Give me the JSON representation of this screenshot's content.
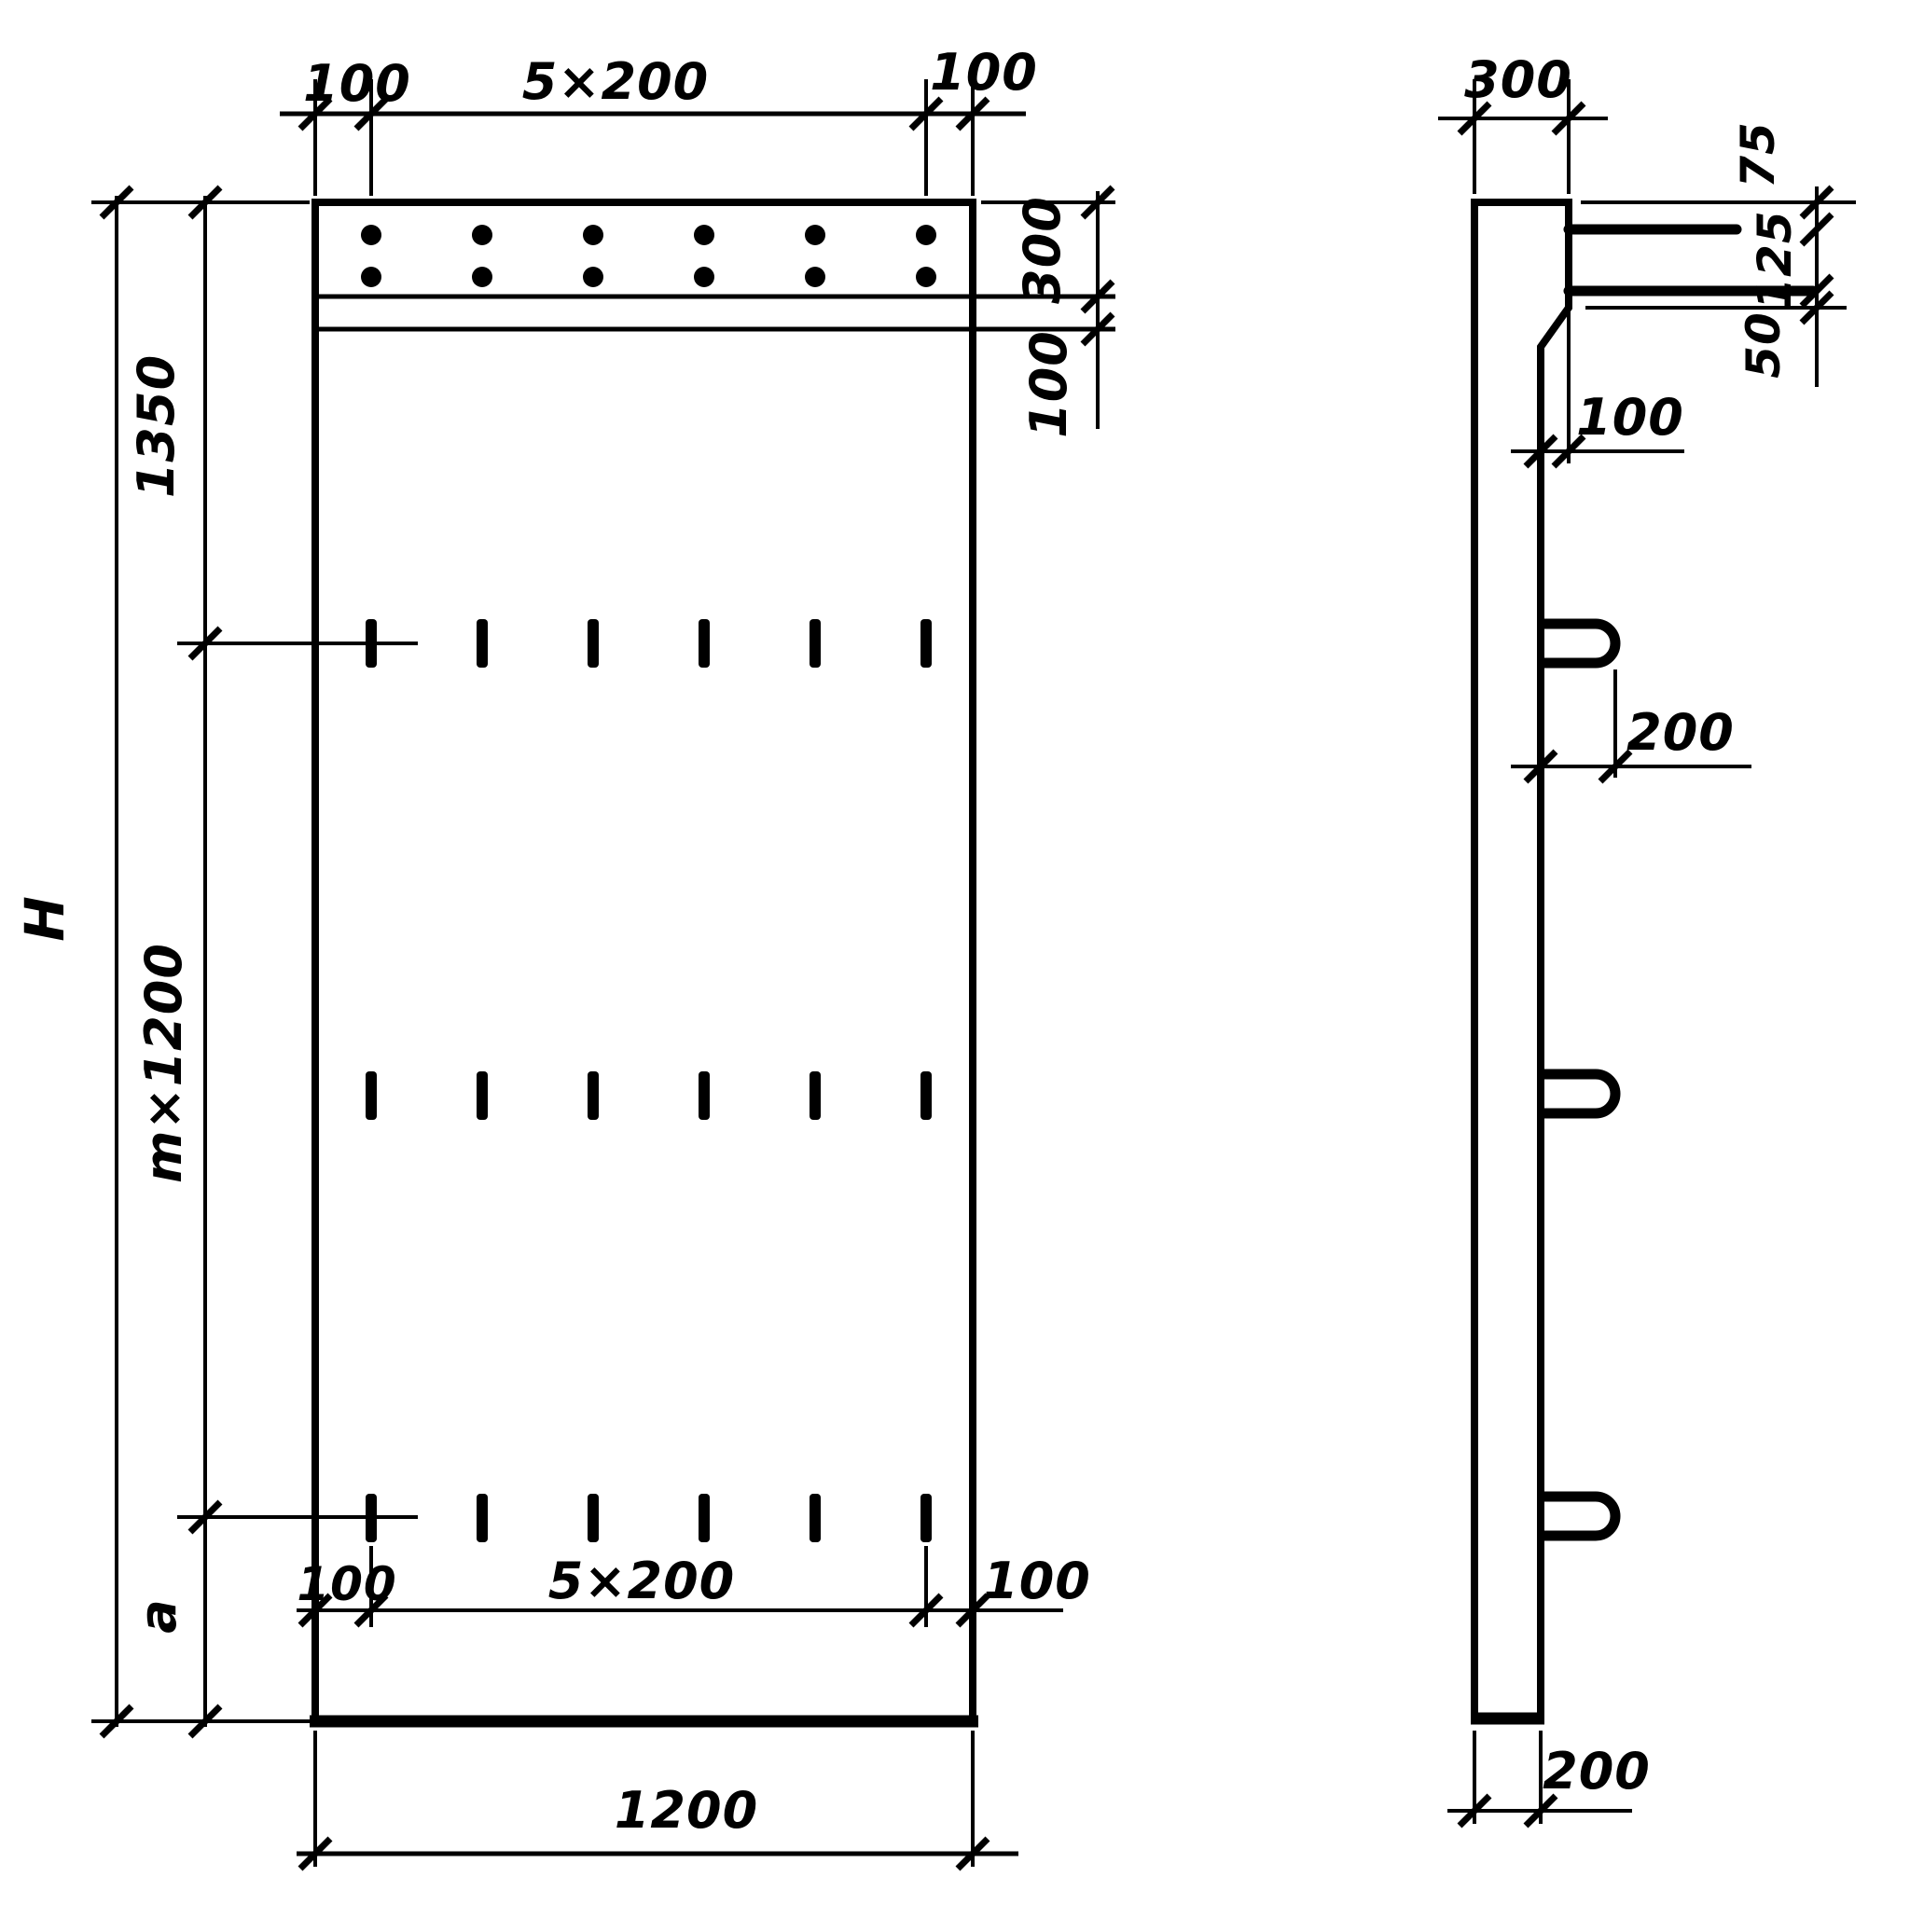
{
  "front_view": {
    "height_label": "H",
    "top_dims": {
      "edge_left": "100",
      "spacing": "5×200",
      "edge_right": "100"
    },
    "left_dims": {
      "upper": "1350",
      "middle": "m×1200",
      "lower": "a"
    },
    "right_dims": {
      "cap_height": "300",
      "below_cap": "100"
    },
    "bottom_dims": {
      "edge_left": "100",
      "spacing": "5×200",
      "edge_right": "100",
      "overall_width": "1200"
    }
  },
  "side_view": {
    "top_width": "300",
    "upper_right_dims": {
      "first": "75",
      "second": "125",
      "third": "50"
    },
    "step_offset": "100",
    "loop_projection": "200",
    "bottom_width": "200"
  }
}
